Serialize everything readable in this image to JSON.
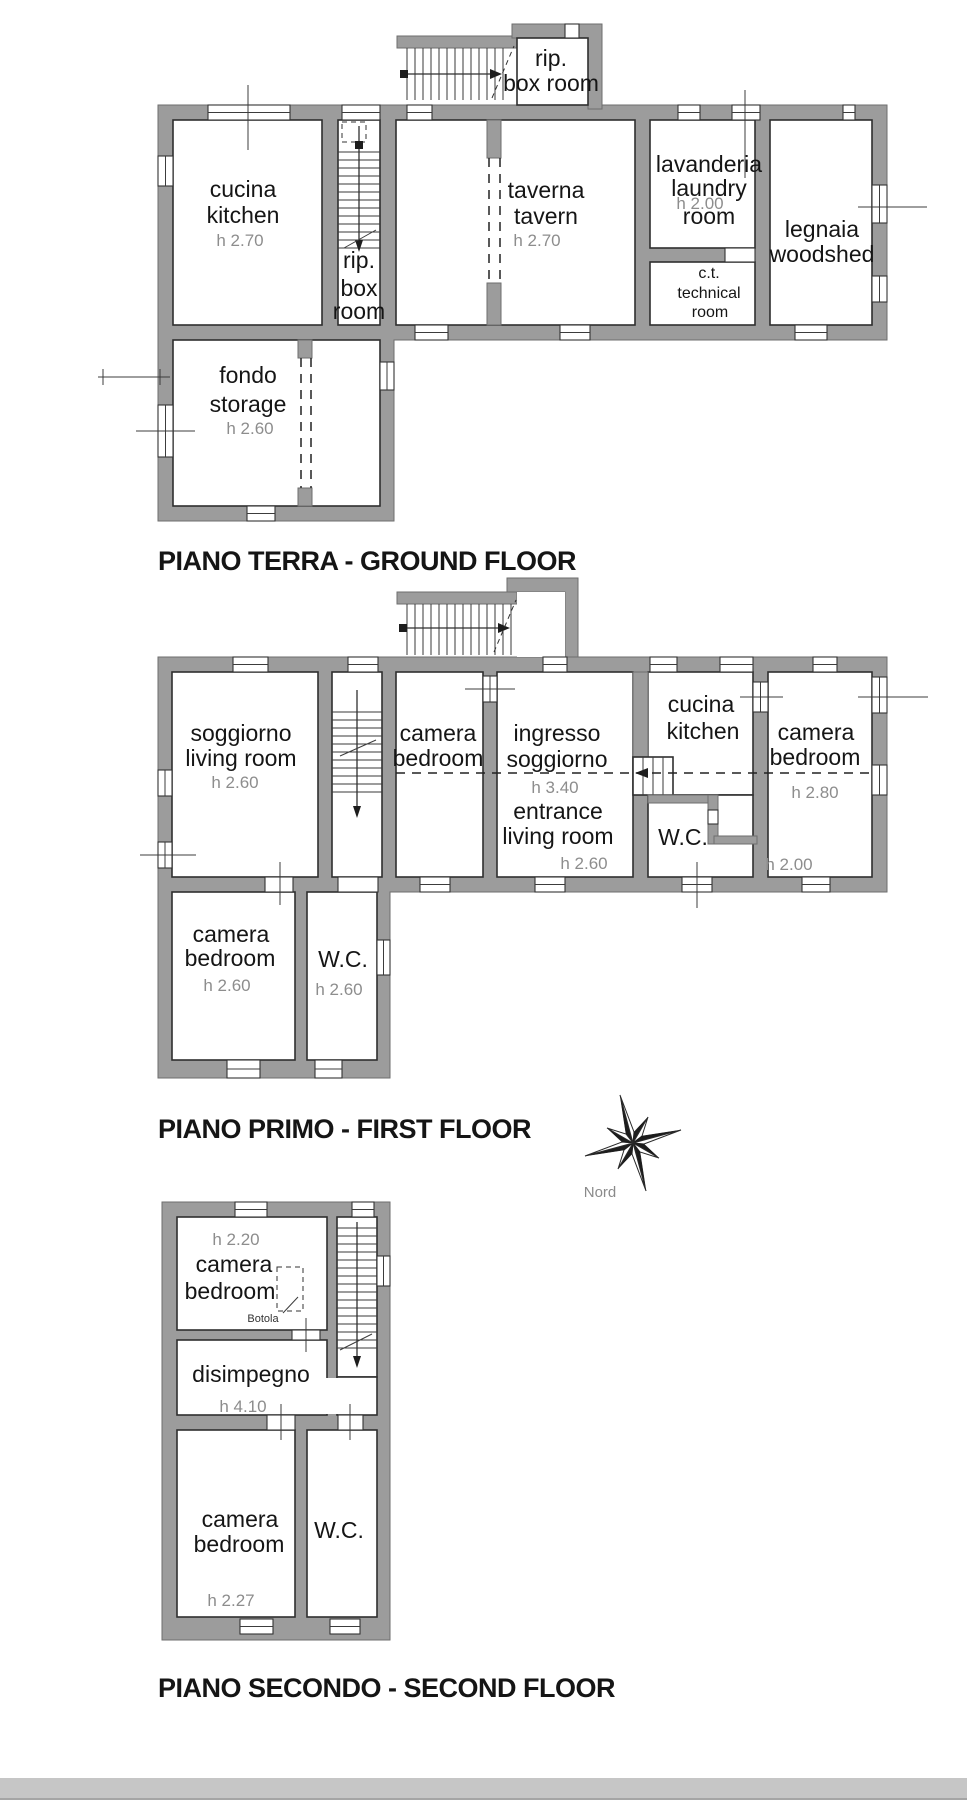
{
  "document": {
    "type": "floor-plan-scan"
  },
  "colors": {
    "wall": "#9c9c9c",
    "line": "#2f2f2f",
    "height_label": "#8d8d8d",
    "scan_band": "#c6c6c6"
  },
  "floors": [
    {
      "id": "ground",
      "title": "PIANO TERRA - GROUND FLOOR",
      "rooms": {
        "box_room_top": {
          "lines": [
            "rip.",
            "box room"
          ]
        },
        "kitchen": {
          "lines": [
            "cucina",
            "kitchen",
            "h 2.70"
          ]
        },
        "stair_box_room": {
          "lines": [
            "rip.",
            "box",
            "room"
          ]
        },
        "tavern": {
          "lines": [
            "taverna",
            "tavern",
            "h 2.70"
          ]
        },
        "laundry": {
          "lines": [
            "lavanderia",
            "laundry",
            "h 2.00",
            "room"
          ]
        },
        "technical_room": {
          "lines": [
            "c.t.",
            "technical",
            "room"
          ]
        },
        "woodshed": {
          "lines": [
            "legnaia",
            "woodshed"
          ]
        },
        "storage": {
          "lines": [
            "fondo",
            "storage",
            "h 2.60"
          ]
        }
      }
    },
    {
      "id": "first",
      "title": "PIANO PRIMO - FIRST FLOOR",
      "rooms": {
        "living_room": {
          "lines": [
            "soggiorno",
            "living room",
            "h 2.60"
          ]
        },
        "bedroom_center": {
          "lines": [
            "camera",
            "bedroom"
          ]
        },
        "entrance_living": {
          "lines": [
            "ingresso",
            "soggiorno",
            "h 3.40",
            "entrance",
            "living room",
            "h 2.60"
          ]
        },
        "kitchen": {
          "lines": [
            "cucina",
            "kitchen"
          ]
        },
        "wc": {
          "lines": [
            "W.C."
          ]
        },
        "bedroom_east": {
          "lines": [
            "camera",
            "bedroom",
            "h 2.80",
            "h 2.00"
          ]
        },
        "bedroom_south": {
          "lines": [
            "camera",
            "bedroom",
            "h 2.60"
          ]
        },
        "wc_south": {
          "lines": [
            "W.C.",
            "h 2.60"
          ]
        }
      }
    },
    {
      "id": "second",
      "title": "PIANO SECONDO - SECOND FLOOR",
      "rooms": {
        "bedroom_north": {
          "lines": [
            "h 2.20",
            "camera",
            "bedroom"
          ]
        },
        "trapdoor": {
          "label": "Botola"
        },
        "hallway": {
          "lines": [
            "disimpegno",
            "h 4.10"
          ]
        },
        "bedroom_south": {
          "lines": [
            "camera",
            "bedroom",
            "h 2.27"
          ]
        },
        "wc": {
          "lines": [
            "W.C."
          ]
        }
      }
    }
  ],
  "compass": {
    "label": "Nord"
  }
}
